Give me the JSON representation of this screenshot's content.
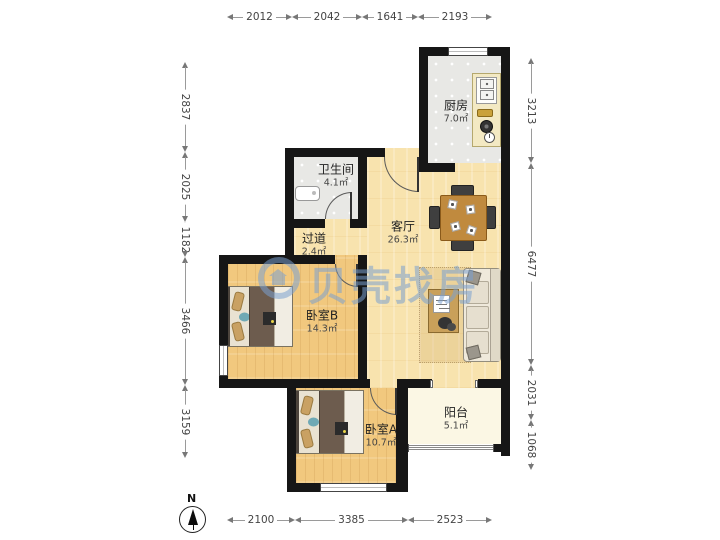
{
  "watermark": {
    "text": "贝壳找房",
    "color": "#7aa0d0"
  },
  "compass": {
    "north_label": "N"
  },
  "dimensions": {
    "top": [
      "2012",
      "2042",
      "1641",
      "2193"
    ],
    "bottom": [
      "2100",
      "3385",
      "2523"
    ],
    "left": [
      "2837",
      "2025",
      "1182",
      "3466",
      "3159"
    ],
    "right": [
      "3213",
      "6477",
      "2031",
      "1068"
    ]
  },
  "rooms": {
    "kitchen": {
      "name": "厨房",
      "area": "7.0㎡"
    },
    "bathroom": {
      "name": "卫生间",
      "area": "4.1㎡"
    },
    "hallway": {
      "name": "过道",
      "area": "2.4㎡"
    },
    "living": {
      "name": "客厅",
      "area": "26.3㎡"
    },
    "bedroom_b": {
      "name": "卧室B",
      "area": "14.3㎡"
    },
    "bedroom_a": {
      "name": "卧室A",
      "area": "10.7㎡"
    },
    "balcony": {
      "name": "阳台",
      "area": "5.1㎡"
    }
  }
}
